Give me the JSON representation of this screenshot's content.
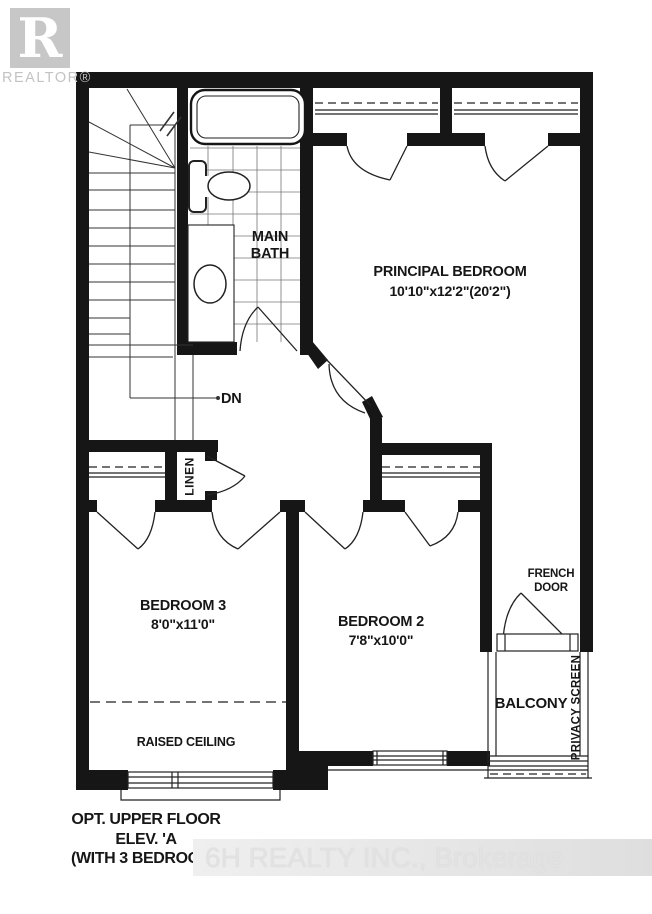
{
  "branding": {
    "realtor_logo_letter": "R",
    "realtor_text": "REALTOR®"
  },
  "plan": {
    "rooms": {
      "principal_bedroom": {
        "name": "PRINCIPAL BEDROOM",
        "dimensions": "10'10\"x12'2\"(20'2\")"
      },
      "bedroom2": {
        "name": "BEDROOM 2",
        "dimensions": "7'8\"x10'0\""
      },
      "bedroom3": {
        "name": "BEDROOM 3",
        "dimensions": "8'0\"x11'0\""
      },
      "main_bath": {
        "name": "MAIN BATH"
      },
      "balcony": {
        "name": "BALCONY"
      },
      "linen": {
        "name": "LINEN"
      }
    },
    "annotations": {
      "stairs_down": "DN",
      "french_door": "FRENCH DOOR",
      "privacy_screen": "PRIVACY SCREEN",
      "raised_ceiling": "RAISED CEILING"
    },
    "colors": {
      "wall": "#161616",
      "thin_line": "#222222",
      "tile_grid": "#777777",
      "watermark_gray": "#c7c7c7"
    }
  },
  "footer": {
    "title_line1": "OPT. UPPER FLOOR",
    "title_line2": "ELEV. 'A",
    "title_line3": "(WITH 3 BEDROOM)'"
  },
  "watermark": "6H REALTY INC., Brokerage"
}
